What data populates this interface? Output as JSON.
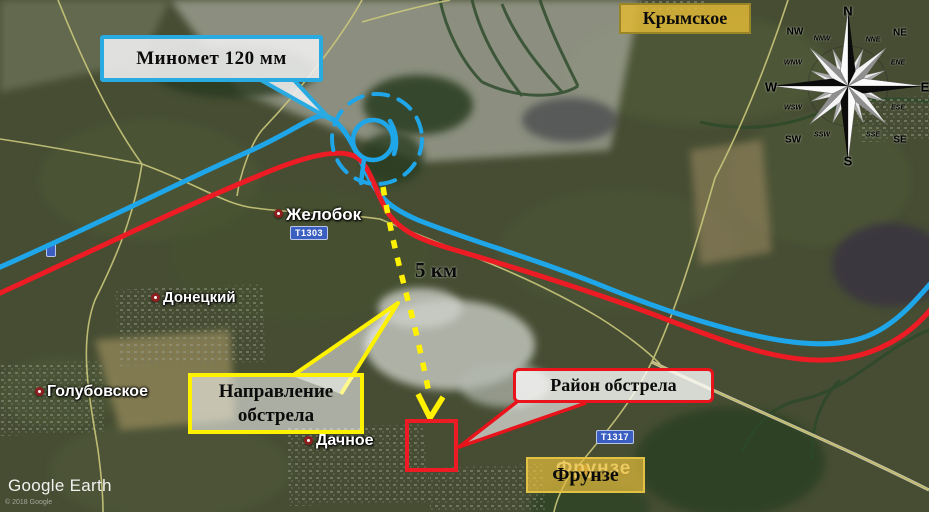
{
  "base_map": {
    "watermark": "Google Earth",
    "copyright": "© 2018 Google",
    "places": [
      {
        "name": "Желобок"
      },
      {
        "name": "Донецкий"
      },
      {
        "name": "Голубовское"
      },
      {
        "name": "Дачное"
      },
      {
        "name": "Фрунзе"
      }
    ],
    "road_shields": [
      {
        "label": "Т1303"
      },
      {
        "label": "Т1317"
      }
    ]
  },
  "overlay": {
    "mortar_callout": "Миномет 120 мм",
    "town_label": "Крымское",
    "frunze_label": "Фрунзе",
    "distance_label": "5 км",
    "direction_line1": "Направление",
    "direction_line2": "обстрела",
    "target_label": "Район обстрела",
    "colors": {
      "blue_line": "#1FA6E8",
      "red_line": "#ED1C24",
      "arrow_yellow": "#FFF100",
      "label_gold": "#DEB537"
    }
  },
  "compass": {
    "cardinal": [
      "N",
      "NE",
      "E",
      "SE",
      "S",
      "SW",
      "W",
      "NW"
    ],
    "ordinal": [
      "NNE",
      "ENE",
      "ESE",
      "SSE",
      "SSW",
      "WSW",
      "WNW",
      "NNW"
    ]
  }
}
